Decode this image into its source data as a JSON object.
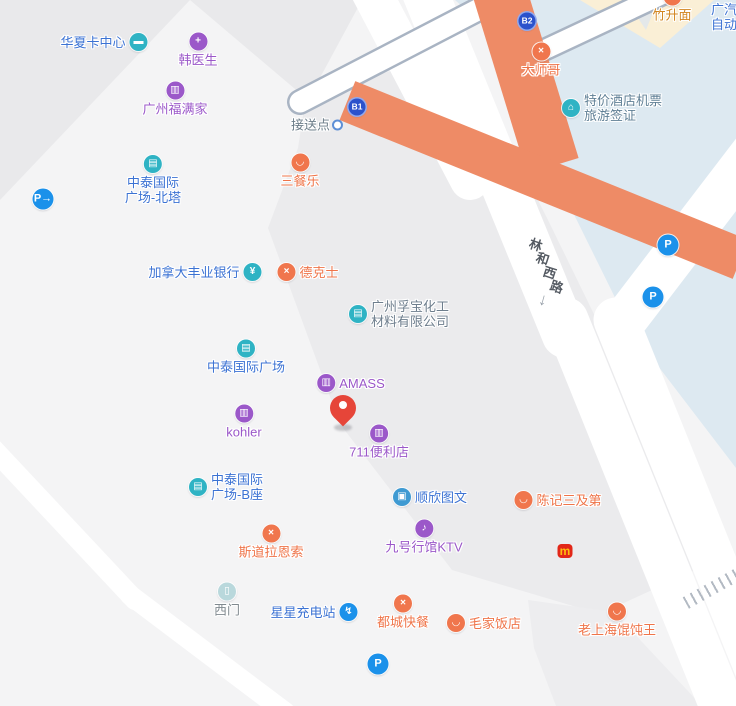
{
  "map": {
    "colors": {
      "base": "#f4f4f5",
      "wedge": "#e9e9eb",
      "block": "#ebebed",
      "block2": "#ededef",
      "blue-area": "#dde9f1",
      "cream": "#faefd6",
      "cream-wedge": "#e4e8ea",
      "road": "#ffffff",
      "flyover-edge": "#a9b4c3",
      "overpass-orange": "#ee8b66",
      "hatch": "#b3bac3",
      "bright-blue": "#1b91ea",
      "badge-blue": "#2b52cc",
      "mcd-red": "#e22718",
      "mcd-yellow": "#ffbc0d",
      "pin-red": "#e64539",
      "road-label": "#555b63"
    },
    "categories": {
      "building": {
        "icon_bg": "#2fb3c4",
        "text": "#3b72d3"
      },
      "company": {
        "icon_bg": "#2fb3c4",
        "text": "#6e7e8d"
      },
      "shop": {
        "icon_bg": "#9b58c9",
        "text": "#9b58c9"
      },
      "food": {
        "icon_bg": "#f0764d",
        "text": "#ef7449"
      },
      "bank": {
        "icon_bg": "#2fb3c4",
        "text": "#3b72d3"
      },
      "print": {
        "icon_bg": "#3f9ad2",
        "text": "#3b72d3"
      },
      "charging": {
        "icon_bg": "#1b91ea",
        "text": "#3b72d3"
      },
      "gate": {
        "icon_bg": "#b9d8dc",
        "text": "#80898f"
      },
      "pickup": {
        "text": "#6b7c88"
      },
      "noodle": {
        "icon_bg": "#f0764d",
        "text": "#d2851f"
      },
      "ticket": {
        "icon_bg": "#2fb3c4",
        "text": "#5f7f95"
      },
      "edge": {
        "text": "#3b72d3"
      },
      "badge": {
        "text": "#ffffff"
      },
      "parking": {
        "text": "#ffffff"
      },
      "mcd": {
        "text": "#ffbc0d"
      }
    },
    "pois": [
      {
        "id": "huaxia-card-center",
        "label": "华夏卡中心",
        "category": "building",
        "icon": "card-icon",
        "glyph": "▬",
        "layout": "icon-right",
        "x": 104,
        "y": 42
      },
      {
        "id": "han-doctor",
        "label": "韩医生",
        "category": "shop",
        "icon": "medical-icon",
        "glyph": "+",
        "layout": "icon-top",
        "x": 198,
        "y": 50
      },
      {
        "id": "guangzhou-fumanjia",
        "label": "广州福满家",
        "category": "shop",
        "icon": "shopping-bag-icon",
        "glyph": "▥",
        "layout": "icon-top",
        "x": 175,
        "y": 99
      },
      {
        "id": "zhongtai-plaza-north-tower",
        "lines": [
          "中泰国际",
          "广场-北塔"
        ],
        "category": "building",
        "icon": "building-icon",
        "glyph": "▤",
        "layout": "icon-top",
        "x": 153,
        "y": 180
      },
      {
        "id": "parking-entrance",
        "category": "parking",
        "icon": "parking-entrance-icon",
        "glyph": "P→",
        "icls": "park",
        "layout": "icon-only",
        "x": 43,
        "y": 199
      },
      {
        "id": "pickup-point",
        "label": "接送点",
        "category": "pickup",
        "icon": "pickup-dot-icon",
        "glyph": "",
        "icls": "dot",
        "layout": "icon-right",
        "x": 316,
        "y": 125
      },
      {
        "id": "exit-b1",
        "category": "badge",
        "icon": "exit-b1-badge",
        "glyph": "B1",
        "icls": "badge",
        "layout": "icon-only",
        "x": 357,
        "y": 107
      },
      {
        "id": "exit-b2",
        "category": "badge",
        "icon": "exit-b2-badge",
        "glyph": "B2",
        "icls": "badge",
        "layout": "icon-only",
        "x": 527,
        "y": 21
      },
      {
        "id": "sancanle",
        "label": "三餐乐",
        "category": "food",
        "icon": "rice-bowl-icon",
        "glyph": "◡",
        "layout": "icon-top",
        "x": 300,
        "y": 171
      },
      {
        "id": "scotiabank",
        "label": "加拿大丰业银行",
        "category": "bank",
        "icon": "yuan-icon",
        "glyph": "¥",
        "layout": "icon-right",
        "x": 205,
        "y": 272
      },
      {
        "id": "dicos",
        "label": "德克士",
        "category": "food",
        "icon": "cutlery-icon",
        "glyph": "×",
        "layout": "icon-left",
        "x": 308,
        "y": 272
      },
      {
        "id": "fubao-chemical",
        "lines": [
          "广州孚宝化工",
          "材料有限公司"
        ],
        "category": "company",
        "icon": "building-icon",
        "glyph": "▤",
        "layout": "icon-left",
        "align": "left",
        "x": 399,
        "y": 314
      },
      {
        "id": "zhongtai-plaza",
        "label": "中泰国际广场",
        "category": "building",
        "icon": "building-icon",
        "glyph": "▤",
        "layout": "icon-top",
        "x": 246,
        "y": 357
      },
      {
        "id": "amass",
        "label": "AMASS",
        "category": "shop",
        "icon": "shopping-bag-icon",
        "glyph": "▥",
        "layout": "icon-left",
        "x": 351,
        "y": 383
      },
      {
        "id": "kohler",
        "label": "kohler",
        "category": "shop",
        "icon": "shopping-bag-icon",
        "glyph": "▥",
        "layout": "icon-top",
        "x": 244,
        "y": 422
      },
      {
        "id": "711-store",
        "label": "711便利店",
        "category": "shop",
        "icon": "storefront-icon",
        "glyph": "▥",
        "layout": "icon-top",
        "x": 379,
        "y": 442
      },
      {
        "id": "zhongtai-plaza-b",
        "lines": [
          "中泰国际",
          "广场-B座"
        ],
        "category": "building",
        "icon": "building-icon",
        "glyph": "▤",
        "layout": "icon-left",
        "align": "left",
        "x": 226,
        "y": 487
      },
      {
        "id": "shunxin-print",
        "label": "顺欣图文",
        "category": "print",
        "icon": "printer-icon",
        "glyph": "▣",
        "layout": "icon-left",
        "x": 430,
        "y": 497
      },
      {
        "id": "chenji-sanjidi",
        "label": "陈记三及第",
        "category": "food",
        "icon": "rice-bowl-icon",
        "glyph": "◡",
        "layout": "icon-left",
        "x": 558,
        "y": 500
      },
      {
        "id": "stora-enso",
        "label": "斯道拉恩索",
        "category": "food",
        "icon": "cutlery-icon",
        "glyph": "×",
        "layout": "icon-top",
        "x": 271,
        "y": 542
      },
      {
        "id": "jiuhao-ktv",
        "label": "九号行馆KTV",
        "category": "shop",
        "icon": "microphone-icon",
        "glyph": "♪",
        "layout": "icon-top",
        "x": 424,
        "y": 537
      },
      {
        "id": "mcdonalds",
        "category": "mcd",
        "icon": "mcdonalds-icon",
        "glyph": "m",
        "icls": "mcd",
        "layout": "icon-only",
        "x": 565,
        "y": 551
      },
      {
        "id": "west-gate",
        "label": "西门",
        "category": "gate",
        "icon": "gate-icon",
        "glyph": "▯",
        "layout": "icon-top",
        "x": 227,
        "y": 600
      },
      {
        "id": "xingxing-charging",
        "label": "星星充电站",
        "category": "charging",
        "icon": "charging-icon",
        "glyph": "↯",
        "layout": "icon-right",
        "x": 314,
        "y": 612
      },
      {
        "id": "ducheng-fastfood",
        "label": "都城快餐",
        "category": "food",
        "icon": "cutlery-icon",
        "glyph": "×",
        "layout": "icon-top",
        "x": 403,
        "y": 612
      },
      {
        "id": "maojia-restaurant",
        "label": "毛家饭店",
        "category": "food",
        "icon": "rice-bowl-icon",
        "glyph": "◡",
        "layout": "icon-left",
        "x": 484,
        "y": 623
      },
      {
        "id": "parking-south",
        "category": "parking",
        "icon": "parking-icon",
        "glyph": "P",
        "icls": "park",
        "layout": "icon-only",
        "x": 378,
        "y": 664
      },
      {
        "id": "laoshanghai-wonton",
        "label": "老上海馄饨王",
        "category": "food",
        "icon": "rice-bowl-icon",
        "glyph": "◡",
        "layout": "icon-top",
        "x": 617,
        "y": 620
      },
      {
        "id": "dashige",
        "label": "大师哥",
        "category": "food",
        "icon": "cutlery-icon",
        "glyph": "×",
        "layout": "icon-top",
        "x": 541,
        "y": 60
      },
      {
        "id": "zhushengmian",
        "label": "竹升面",
        "category": "noodle",
        "icon": "rice-bowl-icon",
        "glyph": "◡",
        "layout": "icon-top",
        "x": 672,
        "y": 5
      },
      {
        "id": "guangqi-partial",
        "lines": [
          "广汽",
          "自动"
        ],
        "category": "edge",
        "layout": "no-icon",
        "align": "edge",
        "x": 711,
        "y": 17
      },
      {
        "id": "tejia-hotel-tickets",
        "lines": [
          "特价酒店机票",
          "旅游签证"
        ],
        "category": "ticket",
        "icon": "hotel-ticket-icon",
        "glyph": "⌂",
        "layout": "icon-left",
        "align": "left",
        "x": 612,
        "y": 108
      },
      {
        "id": "parking-ne",
        "category": "parking",
        "icon": "parking-icon",
        "glyph": "P",
        "icls": "park",
        "layout": "icon-only",
        "x": 668,
        "y": 245
      },
      {
        "id": "parking-e",
        "category": "parking",
        "icon": "parking-icon",
        "glyph": "P",
        "icls": "park",
        "layout": "icon-only",
        "x": 653,
        "y": 297
      }
    ],
    "road_label": {
      "name": "林和西路",
      "chars": [
        "林",
        "和",
        "西",
        "路"
      ],
      "positions": [
        [
          536,
          244
        ],
        [
          543,
          258
        ],
        [
          550,
          272
        ],
        [
          557,
          286
        ]
      ],
      "arrow": "↓",
      "arrow_x": 543,
      "arrow_y": 300
    },
    "pin": {
      "x": 343,
      "y": 428
    }
  }
}
